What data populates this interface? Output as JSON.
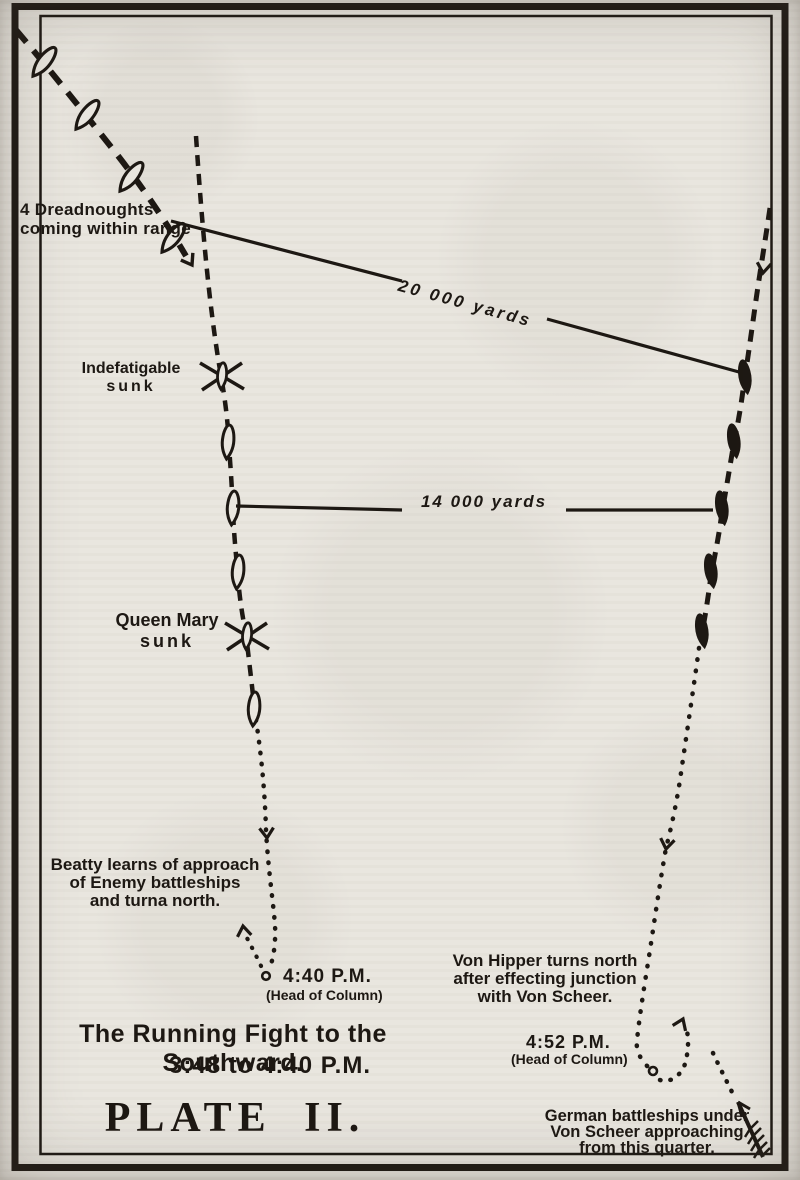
{
  "colors": {
    "ink": "#1d1813",
    "paper": "#e9e6df"
  },
  "plate": {
    "annotations": {
      "dreadnoughts": {
        "line1": "4 Dreadnoughts",
        "line2": "coming within range"
      },
      "range20k": "20 000 yards",
      "range14k": "14 000 yards",
      "indefatigable": {
        "line1": "Indefatigable",
        "line2": "sunk"
      },
      "queen_mary": {
        "line1": "Queen Mary",
        "line2": "sunk"
      },
      "beatty": {
        "line1": "Beatty learns of approach",
        "line2": "of Enemy battleships",
        "line3": "and turna north."
      },
      "time_440": {
        "time": "4:40 P.M.",
        "note": "(Head of Column)"
      },
      "von_hipper": {
        "line1": "Von Hipper turns north",
        "line2": "after effecting junction",
        "line3": "with Von Scheer."
      },
      "time_452": {
        "time": "4:52 P.M.",
        "note": "(Head of Column)"
      },
      "scheer": {
        "line1": "German battleships under",
        "line2": "Von Scheer approaching",
        "line3": "from this quarter."
      }
    },
    "caption": {
      "line1": "The Running Fight to the Southward.",
      "line2": "3:48 to 4:40 P.M."
    },
    "plate_number": "PLATE II."
  }
}
